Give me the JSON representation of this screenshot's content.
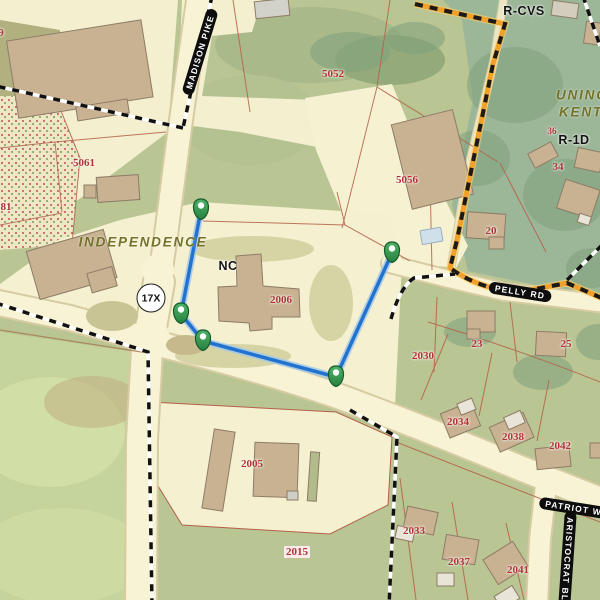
{
  "map": {
    "title": "Independence parcel map",
    "route_marker": {
      "text": "17X"
    },
    "labels": [
      {
        "type": "parcel",
        "text": "9",
        "x": 1,
        "y": 33
      },
      {
        "type": "parcel",
        "text": "5052",
        "x": 333,
        "y": 74
      },
      {
        "type": "parcel",
        "text": "5061",
        "x": 84,
        "y": 163
      },
      {
        "type": "parcel",
        "text": "81",
        "x": 6,
        "y": 207
      },
      {
        "type": "parcel",
        "text": "5056",
        "x": 407,
        "y": 180
      },
      {
        "type": "parcel",
        "text": "36",
        "x": 552,
        "y": 131,
        "small": true
      },
      {
        "type": "parcel",
        "text": "34",
        "x": 558,
        "y": 167
      },
      {
        "type": "parcel",
        "text": "20",
        "x": 491,
        "y": 231
      },
      {
        "type": "parcel",
        "text": "2006",
        "x": 281,
        "y": 300
      },
      {
        "type": "parcel",
        "text": "23",
        "x": 477,
        "y": 344
      },
      {
        "type": "parcel",
        "text": "25",
        "x": 566,
        "y": 344
      },
      {
        "type": "parcel",
        "text": "2030",
        "x": 423,
        "y": 356
      },
      {
        "type": "parcel",
        "text": "2034",
        "x": 458,
        "y": 422
      },
      {
        "type": "parcel",
        "text": "2038",
        "x": 513,
        "y": 437
      },
      {
        "type": "parcel",
        "text": "2042",
        "x": 560,
        "y": 446
      },
      {
        "type": "parcel",
        "text": "2033",
        "x": 414,
        "y": 531
      },
      {
        "type": "parcel",
        "text": "2037",
        "x": 459,
        "y": 562
      },
      {
        "type": "parcel",
        "text": "2041",
        "x": 518,
        "y": 570
      },
      {
        "type": "parcel",
        "text": "2005",
        "x": 252,
        "y": 464
      },
      {
        "type": "parcel",
        "text": "2015",
        "x": 297,
        "y": 552,
        "chip": true
      },
      {
        "type": "zone",
        "text": "R-CVS",
        "x": 524,
        "y": 11
      },
      {
        "type": "zone",
        "text": "R-1D",
        "x": 574,
        "y": 140
      },
      {
        "type": "zone",
        "text": "NC",
        "x": 228,
        "y": 266
      },
      {
        "type": "place",
        "text": "INDEPENDENCE",
        "x": 143,
        "y": 242
      },
      {
        "type": "place",
        "text": "UNINCORPORATED",
        "x": 556,
        "y": 95,
        "anchor": "left"
      },
      {
        "type": "place",
        "text": "KENTON",
        "x": 559,
        "y": 112,
        "anchor": "left"
      },
      {
        "type": "road",
        "text": "MADISON PIKE",
        "x": 200,
        "y": 52,
        "rot": -73
      },
      {
        "type": "road",
        "text": "PELLY RD",
        "x": 520,
        "y": 292,
        "rot": 9
      },
      {
        "type": "road",
        "text": "PATRIOT WAY",
        "x": 580,
        "y": 509,
        "rot": 9
      },
      {
        "type": "road",
        "text": "ARISTOCRAT BLVD",
        "x": 567,
        "y": 566,
        "rot": 94
      }
    ],
    "measurement": {
      "points": [
        [
          201,
          210
        ],
        [
          181,
          314
        ],
        [
          203,
          341
        ],
        [
          336,
          377
        ],
        [
          392,
          253
        ]
      ],
      "line_color": "#2273cf",
      "marker_color": "#2e8b4a"
    },
    "colors": {
      "road_fill": "#f7f3d4",
      "parcel_label_red": "#b03434",
      "boundary_orange": "#f0a12c",
      "city_boundary": "#111111",
      "place_olive": "#72722a"
    }
  }
}
